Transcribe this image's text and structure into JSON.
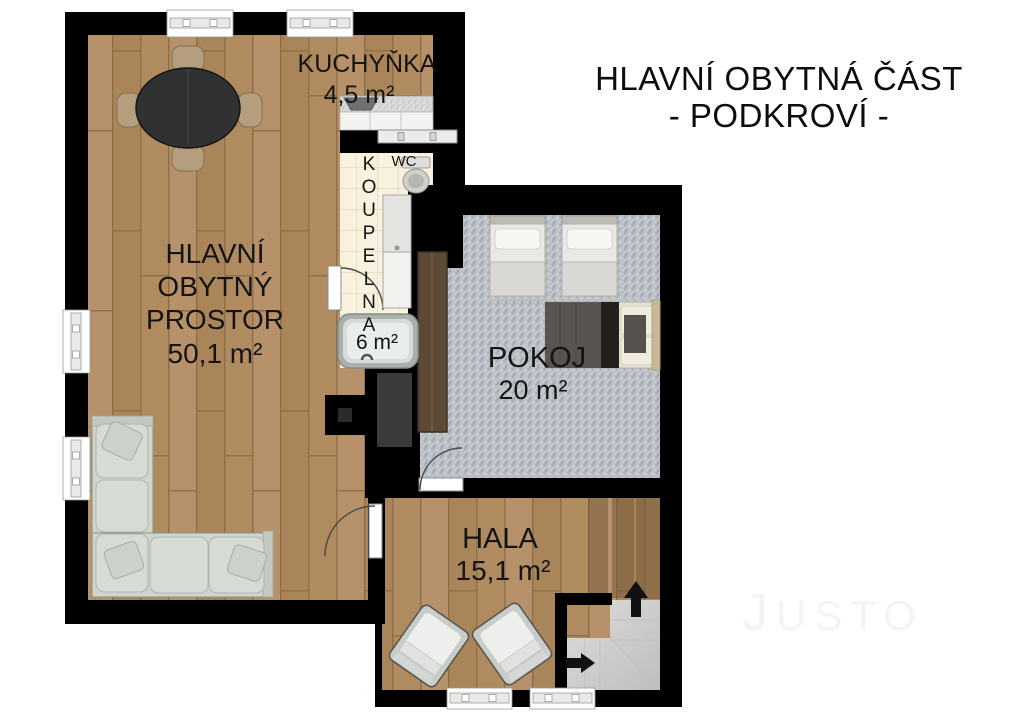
{
  "title": {
    "line1": "HLAVNÍ OBYTNÁ ČÁST",
    "line2": "- PODKROVÍ -"
  },
  "watermark": {
    "initial": "J",
    "rest": "USTO"
  },
  "rooms": {
    "living_room": {
      "label_line1": "HLAVNÍ",
      "label_line2": "OBYTNÝ",
      "label_line3": "PROSTOR",
      "area": "50,1 m²"
    },
    "kitchenette": {
      "label": "KUCHYŇKA",
      "area": "4,5 m²"
    },
    "bathroom": {
      "label": "KOUPELNA",
      "label_letters": [
        "K",
        "O",
        "U",
        "P",
        "E",
        "L",
        "N",
        "A"
      ],
      "area": "6 m²",
      "wc": "WC"
    },
    "bedroom": {
      "label": "POKOJ",
      "area": "20 m²"
    },
    "hall": {
      "label": "HALA",
      "area": "15,1 m²"
    }
  },
  "icons": {
    "stairs_up_arrow": "arrow-up",
    "stairs_entry_arrow": "arrow-right"
  },
  "colors": {
    "wall": "#000000",
    "wood_floor": "#b18c61",
    "carpet": "#bcc0c7",
    "bathroom_tile": "#f8f1de",
    "stairs": "#cfcfcd",
    "sofa": "#cfd5cd",
    "text": "#141414",
    "watermark": "#f4f4f4"
  }
}
